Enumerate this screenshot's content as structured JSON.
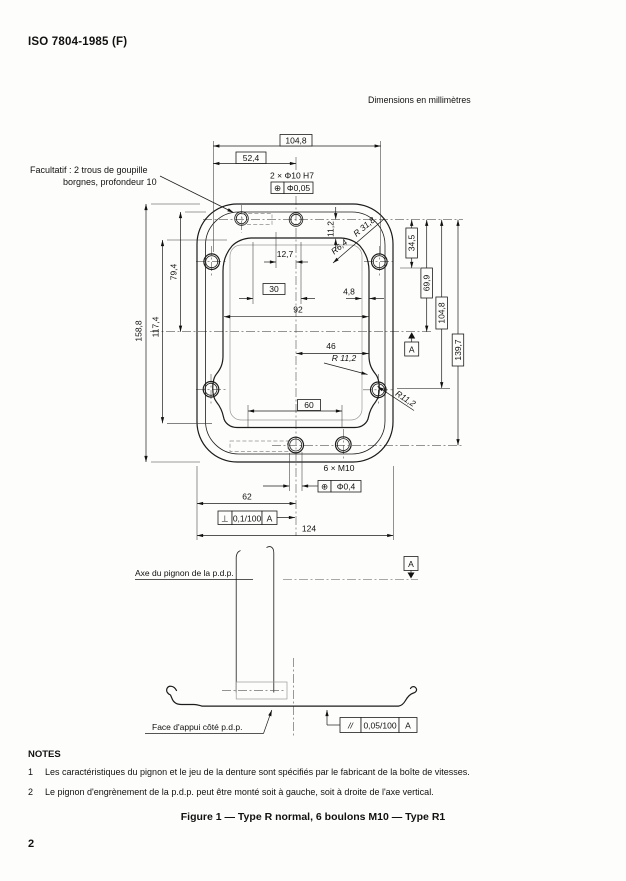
{
  "page": {
    "header": "ISO 7804-1985 (F)",
    "units_note": "Dimensions en millimètres",
    "page_number": "2",
    "figure_caption": "Figure 1 — Type R normal, 6 boulons M10 — Type R1",
    "notes": {
      "heading": "NOTES",
      "items": [
        {
          "num": "1",
          "text": "Les caractéristiques du pignon et le jeu de la denture sont spécifiés par le fabricant de la boîte de vitesses."
        },
        {
          "num": "2",
          "text": "Le pignon d'engrènement de la p.d.p. peut être monté soit à gauche, soit à droite de l'axe vertical."
        }
      ]
    }
  },
  "drawing": {
    "labels": {
      "optional_pin_line1": "Facultatif : 2 trous de goupille",
      "optional_pin_line2": "borgnes, profondeur 10",
      "pin_callout": "2 × Φ10 H7",
      "bolt_callout": "6 × M10",
      "axis_label": "Axe du pignon de la p.d.p.",
      "face_label": "Face d'appui côté p.d.p.",
      "datum": "A"
    },
    "dimensions": {
      "top_width": "104,8",
      "top_half": "52,4",
      "pin_spacing": "12,7",
      "ref_30": "30",
      "opening_width": "92",
      "opening_half": "46",
      "ref_60": "60",
      "lip": "4,8",
      "top_offset": "11,2",
      "r_top_outer": "R 31,8",
      "r_top_inner": "R6,4",
      "r_corner": "R 11,2",
      "r_scallop": "R11,2",
      "right_1": "34,5",
      "right_2": "69,9",
      "right_3": "104,8",
      "right_4": "139,7",
      "left_1": "158,8",
      "left_2": "117,4",
      "left_3": "79,4",
      "bottom_half": "62",
      "bottom_width": "124"
    },
    "tolerances": {
      "pin": {
        "symbol": "⊕",
        "value": "Φ0,05"
      },
      "bolt": {
        "symbol": "⊕",
        "value": "Φ0,4"
      },
      "perp": {
        "symbol": "⊥",
        "value": "0,1/100",
        "datum": "A"
      },
      "para": {
        "symbol": "//",
        "value": "0,05/100",
        "datum": "A"
      }
    }
  }
}
